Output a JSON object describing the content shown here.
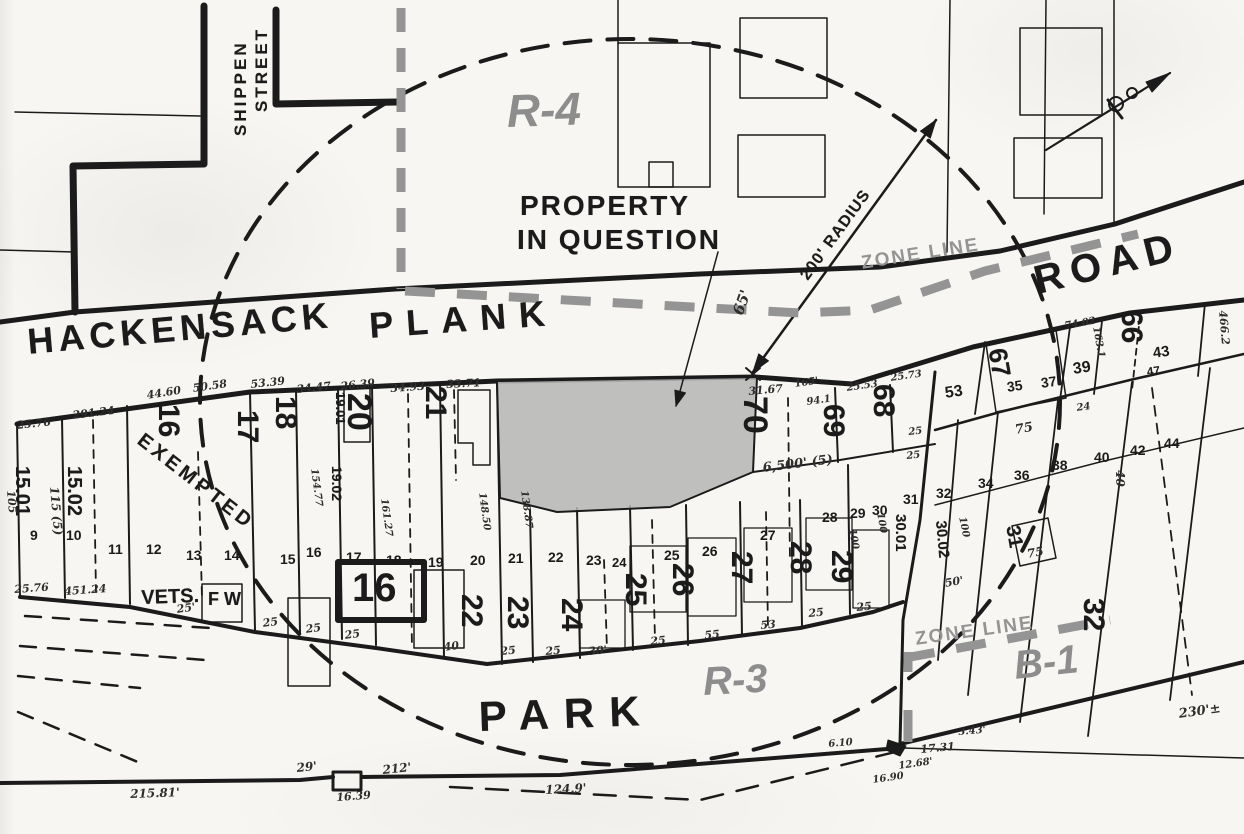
{
  "colors": {
    "ink": "#1b1b1b",
    "zone_gray": "#949494",
    "halftone_text": "#8d8d8d",
    "parcel_fill": "#b5b5b5",
    "paper": "#f7f6f2"
  },
  "labels": [
    {
      "n": "street-shippen",
      "t": "SHIPPEN",
      "x": 232,
      "y": 136,
      "r": -90,
      "s": 17,
      "c": "st",
      "ls": 3
    },
    {
      "n": "street-shippen-2",
      "t": "STREET",
      "x": 253,
      "y": 112,
      "r": -90,
      "s": 17,
      "c": "st",
      "ls": 3
    },
    {
      "n": "street-hackensack",
      "t": "HACKENSACK",
      "x": 26,
      "y": 324,
      "r": -5,
      "s": 36,
      "c": "st",
      "ls": 5
    },
    {
      "n": "street-plank",
      "t": "PLANK",
      "x": 368,
      "y": 308,
      "r": -4,
      "s": 36,
      "c": "st",
      "ls": 13
    },
    {
      "n": "street-road",
      "t": "ROAD",
      "x": 1030,
      "y": 262,
      "r": -14,
      "s": 40,
      "c": "st",
      "ls": 8
    },
    {
      "n": "street-park",
      "t": "PARK",
      "x": 478,
      "y": 696,
      "r": -2,
      "s": 42,
      "c": "st",
      "ls": 15
    },
    {
      "n": "zone-r4",
      "t": "R-4",
      "x": 506,
      "y": 88,
      "r": -2,
      "s": 46,
      "c": "zb"
    },
    {
      "n": "zone-r3",
      "t": "R-3",
      "x": 702,
      "y": 662,
      "r": -3,
      "s": 40,
      "c": "zb"
    },
    {
      "n": "zone-b1",
      "t": "B-1",
      "x": 1012,
      "y": 646,
      "r": -6,
      "s": 40,
      "c": "zb"
    },
    {
      "n": "zone-line-label-north",
      "t": "ZONE LINE",
      "x": 860,
      "y": 254,
      "r": -9,
      "s": 19,
      "c": "zt",
      "ls": 2
    },
    {
      "n": "zone-line-label-south",
      "t": "ZONE LINE",
      "x": 914,
      "y": 630,
      "r": -8,
      "s": 19,
      "c": "zt",
      "ls": 2
    },
    {
      "n": "property-in-question-1",
      "t": "PROPERTY",
      "x": 520,
      "y": 192,
      "r": 0,
      "s": 28,
      "c": "st",
      "ls": 2
    },
    {
      "n": "property-in-question-2",
      "t": "IN QUESTION",
      "x": 517,
      "y": 226,
      "r": 0,
      "s": 28,
      "c": "st",
      "ls": 2
    },
    {
      "n": "radius-label",
      "t": "200' RADIUS",
      "x": 798,
      "y": 274,
      "r": -54,
      "s": 16,
      "c": "st",
      "ls": 1
    },
    {
      "n": "dim-65ft",
      "t": "65'",
      "x": 731,
      "y": 312,
      "r": -70,
      "s": 15,
      "c": "dm"
    },
    {
      "n": "exempted-label",
      "t": "EXEMPTED",
      "x": 146,
      "y": 430,
      "r": 38,
      "s": 20,
      "c": "st",
      "ls": 4
    },
    {
      "n": "vets-label",
      "t": "VETS.",
      "x": 141,
      "y": 588,
      "r": -2,
      "s": 20,
      "c": "st"
    },
    {
      "n": "fw-label",
      "t": "F W",
      "x": 208,
      "y": 590,
      "r": 0,
      "s": 18,
      "c": "st"
    },
    {
      "n": "block-16",
      "t": "16",
      "x": 352,
      "y": 568,
      "r": 0,
      "s": 40,
      "c": "bb"
    },
    {
      "n": "lot-15-01",
      "t": "15.01",
      "x": 32,
      "y": 466,
      "r": 90,
      "s": 20,
      "c": "lb"
    },
    {
      "n": "lot-15-02",
      "t": "15.02",
      "x": 84,
      "y": 466,
      "r": 90,
      "s": 20,
      "c": "lb"
    },
    {
      "n": "lot-16",
      "t": "16",
      "x": 183,
      "y": 404,
      "r": 90,
      "s": 30,
      "c": "lb"
    },
    {
      "n": "lot-17",
      "t": "17",
      "x": 262,
      "y": 410,
      "r": 90,
      "s": 30,
      "c": "lb"
    },
    {
      "n": "lot-18",
      "t": "18",
      "x": 300,
      "y": 396,
      "r": 90,
      "s": 30,
      "c": "lb"
    },
    {
      "n": "lot-19-01",
      "t": "19.01",
      "x": 347,
      "y": 392,
      "r": 90,
      "s": 13,
      "c": "lb"
    },
    {
      "n": "lot-19-02",
      "t": "19.02",
      "x": 344,
      "y": 466,
      "r": 90,
      "s": 14,
      "c": "lb"
    },
    {
      "n": "lot-20",
      "t": "20",
      "x": 376,
      "y": 393,
      "r": 90,
      "s": 34,
      "c": "lb"
    },
    {
      "n": "lot-21",
      "t": "21",
      "x": 450,
      "y": 386,
      "r": 90,
      "s": 30,
      "c": "lb"
    },
    {
      "n": "lot-70",
      "t": "70",
      "x": 772,
      "y": 396,
      "r": 90,
      "s": 34,
      "c": "lb"
    },
    {
      "n": "lot-69",
      "t": "69",
      "x": 848,
      "y": 404,
      "r": 90,
      "s": 30,
      "c": "lb"
    },
    {
      "n": "lot-68",
      "t": "68",
      "x": 898,
      "y": 384,
      "r": 90,
      "s": 30,
      "c": "lb"
    },
    {
      "n": "lot-67",
      "t": "67",
      "x": 1010,
      "y": 346,
      "r": 80,
      "s": 26,
      "c": "lb"
    },
    {
      "n": "lot-66",
      "t": "66",
      "x": 1146,
      "y": 310,
      "r": 90,
      "s": 30,
      "c": "lb"
    },
    {
      "n": "lot-22",
      "t": "22",
      "x": 486,
      "y": 594,
      "r": 90,
      "s": 30,
      "c": "lb"
    },
    {
      "n": "lot-23",
      "t": "23",
      "x": 532,
      "y": 596,
      "r": 90,
      "s": 30,
      "c": "lb"
    },
    {
      "n": "lot-24",
      "t": "24",
      "x": 586,
      "y": 598,
      "r": 90,
      "s": 30,
      "c": "lb"
    },
    {
      "n": "lot-25",
      "t": "25",
      "x": 650,
      "y": 573,
      "r": 90,
      "s": 30,
      "c": "lb"
    },
    {
      "n": "lot-26",
      "t": "26",
      "x": 697,
      "y": 563,
      "r": 90,
      "s": 30,
      "c": "lb"
    },
    {
      "n": "lot-27",
      "t": "27",
      "x": 756,
      "y": 551,
      "r": 90,
      "s": 30,
      "c": "lb"
    },
    {
      "n": "lot-28",
      "t": "28",
      "x": 815,
      "y": 541,
      "r": 90,
      "s": 30,
      "c": "lb"
    },
    {
      "n": "lot-29",
      "t": "29",
      "x": 856,
      "y": 550,
      "r": 90,
      "s": 30,
      "c": "lb"
    },
    {
      "n": "lot-32",
      "t": "32",
      "x": 1108,
      "y": 598,
      "r": 90,
      "s": 30,
      "c": "lb"
    },
    {
      "n": "lot-30-01",
      "t": "30.01",
      "x": 908,
      "y": 514,
      "r": 90,
      "s": 15,
      "c": "lb"
    },
    {
      "n": "lot-30-02",
      "t": "30.02",
      "x": 948,
      "y": 520,
      "r": 85,
      "s": 15,
      "c": "lb"
    },
    {
      "n": "lot-31-boxed",
      "t": "31",
      "x": 1022,
      "y": 524,
      "r": 80,
      "s": 20,
      "c": "lb"
    },
    {
      "n": "dim-115-5",
      "t": "115 (5)",
      "x": 60,
      "y": 486,
      "r": 85,
      "s": 12,
      "c": "dm"
    },
    {
      "n": "dim-105",
      "t": "105",
      "x": 16,
      "y": 490,
      "r": 85,
      "s": 11,
      "c": "dm"
    },
    {
      "n": "sublot-9",
      "t": "9",
      "x": 30,
      "y": 528,
      "r": 0,
      "s": 14,
      "c": "sm"
    },
    {
      "n": "sublot-10",
      "t": "10",
      "x": 66,
      "y": 528,
      "r": 0,
      "s": 14,
      "c": "sm"
    },
    {
      "n": "sublot-11",
      "t": "11",
      "x": 108,
      "y": 542,
      "r": 0,
      "s": 14,
      "c": "sm"
    },
    {
      "n": "sublot-12",
      "t": "12",
      "x": 146,
      "y": 542,
      "r": 0,
      "s": 14,
      "c": "sm"
    },
    {
      "n": "sublot-13",
      "t": "13",
      "x": 186,
      "y": 548,
      "r": 0,
      "s": 14,
      "c": "sm"
    },
    {
      "n": "sublot-14",
      "t": "14",
      "x": 224,
      "y": 548,
      "r": 0,
      "s": 14,
      "c": "sm"
    },
    {
      "n": "sublot-15",
      "t": "15",
      "x": 280,
      "y": 552,
      "r": 0,
      "s": 14,
      "c": "sm"
    },
    {
      "n": "sublot-16",
      "t": "16",
      "x": 306,
      "y": 545,
      "r": 0,
      "s": 14,
      "c": "sm"
    },
    {
      "n": "sublot-17",
      "t": "17",
      "x": 346,
      "y": 550,
      "r": 0,
      "s": 14,
      "c": "sm"
    },
    {
      "n": "sublot-18",
      "t": "18",
      "x": 386,
      "y": 553,
      "r": 0,
      "s": 14,
      "c": "sm"
    },
    {
      "n": "sublot-19",
      "t": "19",
      "x": 428,
      "y": 555,
      "r": 0,
      "s": 14,
      "c": "sm"
    },
    {
      "n": "sublot-20",
      "t": "20",
      "x": 470,
      "y": 553,
      "r": 0,
      "s": 14,
      "c": "sm"
    },
    {
      "n": "sublot-21",
      "t": "21",
      "x": 508,
      "y": 551,
      "r": 0,
      "s": 14,
      "c": "sm"
    },
    {
      "n": "sublot-22",
      "t": "22",
      "x": 548,
      "y": 550,
      "r": 0,
      "s": 14,
      "c": "sm"
    },
    {
      "n": "sublot-23",
      "t": "23",
      "x": 586,
      "y": 553,
      "r": 0,
      "s": 14,
      "c": "sm"
    },
    {
      "n": "sublot-24",
      "t": "24",
      "x": 612,
      "y": 556,
      "r": 0,
      "s": 13,
      "c": "sm"
    },
    {
      "n": "sublot-25",
      "t": "25",
      "x": 664,
      "y": 548,
      "r": 0,
      "s": 14,
      "c": "sm"
    },
    {
      "n": "sublot-26",
      "t": "26",
      "x": 702,
      "y": 544,
      "r": 0,
      "s": 14,
      "c": "sm"
    },
    {
      "n": "sublot-27",
      "t": "27",
      "x": 760,
      "y": 528,
      "r": 0,
      "s": 14,
      "c": "sm"
    },
    {
      "n": "sublot-28",
      "t": "28",
      "x": 822,
      "y": 510,
      "r": 0,
      "s": 14,
      "c": "sm"
    },
    {
      "n": "sublot-29",
      "t": "29",
      "x": 850,
      "y": 506,
      "r": 0,
      "s": 14,
      "c": "sm"
    },
    {
      "n": "sublot-30",
      "t": "30",
      "x": 872,
      "y": 503,
      "r": 0,
      "s": 14,
      "c": "sm"
    },
    {
      "n": "sublot-31",
      "t": "31",
      "x": 903,
      "y": 492,
      "r": 0,
      "s": 14,
      "c": "sm"
    },
    {
      "n": "sublot-32",
      "t": "32",
      "x": 936,
      "y": 486,
      "r": 0,
      "s": 14,
      "c": "sm"
    },
    {
      "n": "sublot-34",
      "t": "34",
      "x": 978,
      "y": 476,
      "r": 0,
      "s": 14,
      "c": "sm"
    },
    {
      "n": "sublot-36",
      "t": "36",
      "x": 1014,
      "y": 468,
      "r": 0,
      "s": 14,
      "c": "sm"
    },
    {
      "n": "sublot-38",
      "t": "38",
      "x": 1052,
      "y": 458,
      "r": 0,
      "s": 14,
      "c": "sm"
    },
    {
      "n": "sublot-40",
      "t": "40",
      "x": 1094,
      "y": 450,
      "r": 0,
      "s": 14,
      "c": "sm"
    },
    {
      "n": "sublot-42",
      "t": "42",
      "x": 1130,
      "y": 443,
      "r": 0,
      "s": 14,
      "c": "sm"
    },
    {
      "n": "sublot-44",
      "t": "44",
      "x": 1164,
      "y": 436,
      "r": 0,
      "s": 14,
      "c": "sm"
    },
    {
      "n": "sublot-53",
      "t": "53",
      "x": 944,
      "y": 386,
      "r": -8,
      "s": 16,
      "c": "sm"
    },
    {
      "n": "sublot-35",
      "t": "35",
      "x": 1006,
      "y": 380,
      "r": -8,
      "s": 14,
      "c": "sm"
    },
    {
      "n": "sublot-37",
      "t": "37",
      "x": 1040,
      "y": 376,
      "r": -8,
      "s": 14,
      "c": "sm"
    },
    {
      "n": "sublot-39",
      "t": "39",
      "x": 1072,
      "y": 362,
      "r": -8,
      "s": 16,
      "c": "sm"
    },
    {
      "n": "sublot-43",
      "t": "43",
      "x": 1152,
      "y": 346,
      "r": -8,
      "s": 15,
      "c": "sm"
    },
    {
      "n": "sublot-47",
      "t": "47",
      "x": 1146,
      "y": 366,
      "r": -8,
      "s": 12,
      "c": "sm"
    },
    {
      "n": "dim-75-upper",
      "t": "75",
      "x": 1014,
      "y": 424,
      "r": -10,
      "s": 13,
      "c": "dm"
    },
    {
      "n": "dim-75-lower",
      "t": "75",
      "x": 1026,
      "y": 548,
      "r": -10,
      "s": 12,
      "c": "dm"
    },
    {
      "n": "dim-24-right",
      "t": "24",
      "x": 1076,
      "y": 404,
      "r": -8,
      "s": 10,
      "c": "dm"
    },
    {
      "n": "dim-40-rot",
      "t": "40",
      "x": 1126,
      "y": 470,
      "r": 90,
      "s": 12,
      "c": "dm"
    },
    {
      "n": "dim-25-76-top",
      "t": "25.76",
      "x": 16,
      "y": 420,
      "r": -6,
      "s": 11,
      "c": "dm"
    },
    {
      "n": "dim-291-24",
      "t": "291.24",
      "x": 72,
      "y": 410,
      "r": -7,
      "s": 11,
      "c": "dm"
    },
    {
      "n": "dim-44-60",
      "t": "44.60",
      "x": 146,
      "y": 390,
      "r": -9,
      "s": 11,
      "c": "dm"
    },
    {
      "n": "dim-50-58",
      "t": "50.58",
      "x": 192,
      "y": 383,
      "r": -8,
      "s": 11,
      "c": "dm"
    },
    {
      "n": "dim-53-39",
      "t": "53.39",
      "x": 250,
      "y": 379,
      "r": -6,
      "s": 11,
      "c": "dm"
    },
    {
      "n": "dim-34-47",
      "t": "34.47",
      "x": 296,
      "y": 384,
      "r": -6,
      "s": 11,
      "c": "dm"
    },
    {
      "n": "dim-26-39",
      "t": "26.39",
      "x": 340,
      "y": 381,
      "r": -6,
      "s": 11,
      "c": "dm"
    },
    {
      "n": "dim-34-93",
      "t": "34.93",
      "x": 390,
      "y": 383,
      "r": -4,
      "s": 11,
      "c": "dm"
    },
    {
      "n": "dim-33-71",
      "t": "33.71",
      "x": 446,
      "y": 379,
      "r": -3,
      "s": 11,
      "c": "dm"
    },
    {
      "n": "dim-31-67",
      "t": "31.67",
      "x": 748,
      "y": 386,
      "r": -5,
      "s": 11,
      "c": "dm"
    },
    {
      "n": "dim-165",
      "t": "165'",
      "x": 794,
      "y": 380,
      "r": -8,
      "s": 10,
      "c": "dm"
    },
    {
      "n": "dim-94-1",
      "t": "94.1",
      "x": 806,
      "y": 398,
      "r": -8,
      "s": 10,
      "c": "dm"
    },
    {
      "n": "dim-6500-5",
      "t": "6,500' (5)",
      "x": 762,
      "y": 462,
      "r": -7,
      "s": 13,
      "c": "dm"
    },
    {
      "n": "dim-25-53",
      "t": "25.53",
      "x": 846,
      "y": 384,
      "r": -8,
      "s": 10,
      "c": "dm"
    },
    {
      "n": "dim-25-73",
      "t": "25.73",
      "x": 890,
      "y": 374,
      "r": -8,
      "s": 10,
      "c": "dm"
    },
    {
      "n": "dim-25-a",
      "t": "25",
      "x": 908,
      "y": 428,
      "r": -6,
      "s": 10,
      "c": "dm"
    },
    {
      "n": "dim-25-b",
      "t": "25",
      "x": 906,
      "y": 452,
      "r": -6,
      "s": 10,
      "c": "dm"
    },
    {
      "n": "dim-74-02",
      "t": "74.02",
      "x": 1064,
      "y": 322,
      "r": -10,
      "s": 10,
      "c": "dm"
    },
    {
      "n": "dim-163-1",
      "t": "163.1",
      "x": 1100,
      "y": 326,
      "r": 80,
      "s": 10,
      "c": "dm"
    },
    {
      "n": "dim-466-2",
      "t": "466.2",
      "x": 1228,
      "y": 310,
      "r": 85,
      "s": 11,
      "c": "dm"
    },
    {
      "n": "dim-148-50",
      "t": "148.50",
      "x": 486,
      "y": 492,
      "r": 82,
      "s": 10,
      "c": "dm"
    },
    {
      "n": "dim-138-87",
      "t": "138.87",
      "x": 528,
      "y": 490,
      "r": 82,
      "s": 10,
      "c": "dm"
    },
    {
      "n": "dim-161-27",
      "t": "161.27",
      "x": 388,
      "y": 498,
      "r": 82,
      "s": 10,
      "c": "dm"
    },
    {
      "n": "dim-154-77",
      "t": "154.77",
      "x": 318,
      "y": 468,
      "r": 82,
      "s": 10,
      "c": "dm"
    },
    {
      "n": "dim-25-76-bottom",
      "t": "25.76",
      "x": 14,
      "y": 584,
      "r": -4,
      "s": 11,
      "c": "dm"
    },
    {
      "n": "dim-451-24",
      "t": "451.24",
      "x": 64,
      "y": 586,
      "r": -4,
      "s": 11,
      "c": "dm"
    },
    {
      "n": "dim-25-ft",
      "t": "25'",
      "x": 176,
      "y": 604,
      "r": -8,
      "s": 11,
      "c": "dm"
    },
    {
      "n": "dim-25-c",
      "t": "25",
      "x": 262,
      "y": 618,
      "r": -8,
      "s": 11,
      "c": "dm"
    },
    {
      "n": "dim-25-d",
      "t": "25",
      "x": 305,
      "y": 624,
      "r": -8,
      "s": 11,
      "c": "dm"
    },
    {
      "n": "dim-25-e",
      "t": "25",
      "x": 344,
      "y": 630,
      "r": -8,
      "s": 11,
      "c": "dm"
    },
    {
      "n": "dim-40-b",
      "t": "40",
      "x": 443,
      "y": 642,
      "r": -8,
      "s": 11,
      "c": "dm"
    },
    {
      "n": "dim-25-f",
      "t": "25",
      "x": 500,
      "y": 646,
      "r": -5,
      "s": 11,
      "c": "dm"
    },
    {
      "n": "dim-25-g",
      "t": "25",
      "x": 545,
      "y": 646,
      "r": -5,
      "s": 11,
      "c": "dm"
    },
    {
      "n": "dim-30-ft",
      "t": "30'",
      "x": 588,
      "y": 646,
      "r": -5,
      "s": 11,
      "c": "dm"
    },
    {
      "n": "dim-25-h",
      "t": "25",
      "x": 650,
      "y": 636,
      "r": -5,
      "s": 11,
      "c": "dm"
    },
    {
      "n": "dim-55",
      "t": "55",
      "x": 704,
      "y": 630,
      "r": -5,
      "s": 11,
      "c": "dm"
    },
    {
      "n": "dim-53-b",
      "t": "53",
      "x": 760,
      "y": 620,
      "r": -5,
      "s": 11,
      "c": "dm"
    },
    {
      "n": "dim-25-i",
      "t": "25",
      "x": 808,
      "y": 608,
      "r": -5,
      "s": 11,
      "c": "dm"
    },
    {
      "n": "dim-25-j",
      "t": "25",
      "x": 856,
      "y": 602,
      "r": -5,
      "s": 11,
      "c": "dm"
    },
    {
      "n": "dim-100-a",
      "t": "100",
      "x": 884,
      "y": 512,
      "r": 80,
      "s": 10,
      "c": "dm"
    },
    {
      "n": "dim-100-b",
      "t": "100",
      "x": 966,
      "y": 516,
      "r": 78,
      "s": 10,
      "c": "dm"
    },
    {
      "n": "dim-100-c",
      "t": "100",
      "x": 856,
      "y": 528,
      "r": 80,
      "s": 10,
      "c": "dm"
    },
    {
      "n": "dim-50-ft",
      "t": "50'",
      "x": 944,
      "y": 578,
      "r": -10,
      "s": 11,
      "c": "dm"
    },
    {
      "n": "dim-215-81",
      "t": "215.81'",
      "x": 130,
      "y": 788,
      "r": -2,
      "s": 12,
      "c": "dm"
    },
    {
      "n": "dim-29-ft",
      "t": "29'",
      "x": 296,
      "y": 762,
      "r": -6,
      "s": 12,
      "c": "dm"
    },
    {
      "n": "dim-212-ft",
      "t": "212'",
      "x": 382,
      "y": 764,
      "r": -6,
      "s": 12,
      "c": "dm"
    },
    {
      "n": "dim-16-39",
      "t": "16.39",
      "x": 336,
      "y": 792,
      "r": -4,
      "s": 11,
      "c": "dm"
    },
    {
      "n": "dim-124-9",
      "t": "124.9'",
      "x": 545,
      "y": 784,
      "r": -3,
      "s": 12,
      "c": "dm"
    },
    {
      "n": "dim-230",
      "t": "230'±",
      "x": 1178,
      "y": 708,
      "r": -8,
      "s": 13,
      "c": "dm"
    },
    {
      "n": "dim-6-10",
      "t": "6.10",
      "x": 828,
      "y": 740,
      "r": -5,
      "s": 10,
      "c": "dm"
    },
    {
      "n": "dim-17-31",
      "t": "17.31",
      "x": 920,
      "y": 744,
      "r": -5,
      "s": 11,
      "c": "dm"
    },
    {
      "n": "dim-12-68",
      "t": "12.68'",
      "x": 898,
      "y": 762,
      "r": -8,
      "s": 10,
      "c": "dm"
    },
    {
      "n": "dim-16-90",
      "t": "16.90",
      "x": 872,
      "y": 776,
      "r": -8,
      "s": 10,
      "c": "dm"
    },
    {
      "n": "dim-3-43",
      "t": "3.43'",
      "x": 958,
      "y": 728,
      "r": -5,
      "s": 10,
      "c": "dm"
    }
  ]
}
